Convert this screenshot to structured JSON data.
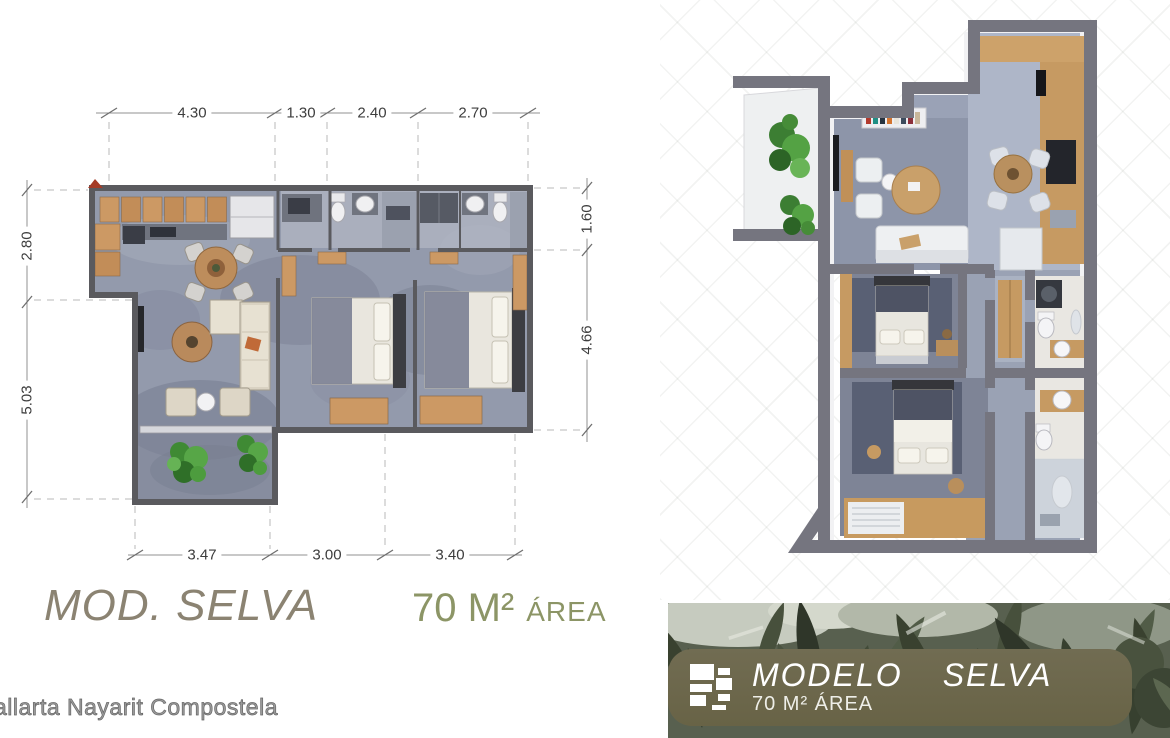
{
  "floorplan": {
    "dims_top": [
      "4.30",
      "1.30",
      "2.40",
      "2.70"
    ],
    "dims_bottom": [
      "3.47",
      "3.00",
      "3.40"
    ],
    "dims_left": [
      "2.80",
      "5.03"
    ],
    "dims_right": [
      "1.60",
      "4.66"
    ]
  },
  "titles": {
    "model": "MOD. SELVA",
    "area_value": "70 M²",
    "area_label": "ÁREA"
  },
  "watermark": {
    "text": "allarta Nayarit Compostela"
  },
  "banner": {
    "model_label": "MODELO",
    "name_label": "SELVA",
    "area_label": "70 M² ÁREA",
    "logo": "planks-logo-icon"
  },
  "colors": {
    "title_taupe": "#8b8372",
    "area_green": "#8c9566",
    "banner_pill_olive": "#6b6749",
    "leaf_dark_green": "#39412f",
    "wall_gray_3d": "#75757f",
    "floor_blue_gray": "#8d95a9",
    "plan_floor": "#939aac",
    "wood_tan": "#c69a62",
    "plant_green": "#4f9b3f",
    "marker_red": "#a53b26"
  }
}
